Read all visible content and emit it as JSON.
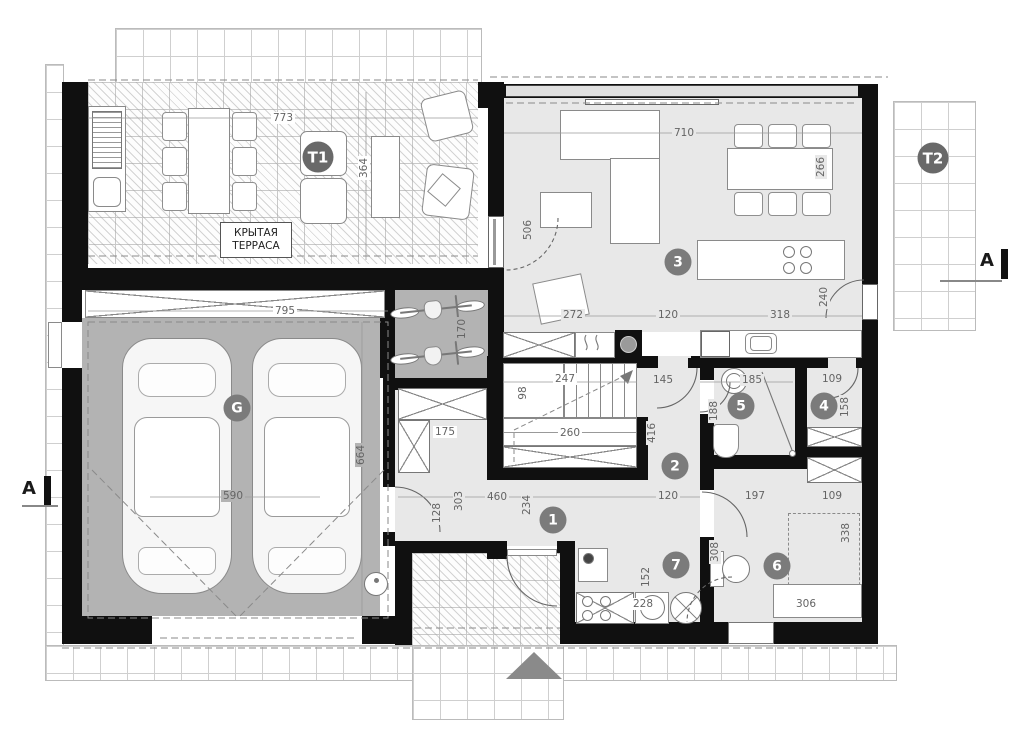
{
  "drawing": {
    "type": "architectural-floor-plan",
    "terrace_label": {
      "line1": "КРЫТАЯ",
      "line2": "ТЕРРАСА"
    },
    "section_label": "A",
    "colors": {
      "wall": "#101010",
      "interior_floor": "#e8e8e8",
      "garage_floor": "#b3b3b3",
      "badge": "#7b7b7b",
      "terrace_badge": "#696969",
      "dim_text": "#646464",
      "entry_arrow": "#8a8a8a"
    },
    "room_badges": [
      {
        "label": "T1",
        "x": 318,
        "y": 157,
        "kind": "t"
      },
      {
        "label": "T2",
        "x": 933,
        "y": 158,
        "kind": "t"
      },
      {
        "label": "G",
        "x": 237,
        "y": 408,
        "kind": "room"
      },
      {
        "label": "1",
        "x": 553,
        "y": 520,
        "kind": "room"
      },
      {
        "label": "2",
        "x": 675,
        "y": 466,
        "kind": "room"
      },
      {
        "label": "3",
        "x": 678,
        "y": 262,
        "kind": "room"
      },
      {
        "label": "4",
        "x": 824,
        "y": 406,
        "kind": "room"
      },
      {
        "label": "5",
        "x": 741,
        "y": 406,
        "kind": "room"
      },
      {
        "label": "6",
        "x": 777,
        "y": 566,
        "kind": "room"
      },
      {
        "label": "7",
        "x": 676,
        "y": 565,
        "kind": "room"
      }
    ],
    "dimensions": [
      {
        "text": "773",
        "x": 283,
        "y": 118,
        "rot": 0,
        "bg": "w"
      },
      {
        "text": "364",
        "x": 364,
        "y": 168,
        "rot": 90,
        "bg": "w"
      },
      {
        "text": "710",
        "x": 684,
        "y": 133,
        "rot": 0,
        "bg": "f"
      },
      {
        "text": "266",
        "x": 821,
        "y": 167,
        "rot": 90,
        "bg": "f"
      },
      {
        "text": "506",
        "x": 528,
        "y": 230,
        "rot": 90,
        "bg": "f"
      },
      {
        "text": "272",
        "x": 573,
        "y": 315,
        "rot": 0,
        "bg": "f"
      },
      {
        "text": "120",
        "x": 668,
        "y": 315,
        "rot": 0,
        "bg": "f"
      },
      {
        "text": "318",
        "x": 780,
        "y": 315,
        "rot": 0,
        "bg": "f"
      },
      {
        "text": "240",
        "x": 824,
        "y": 297,
        "rot": 90,
        "bg": "f"
      },
      {
        "text": "795",
        "x": 285,
        "y": 311,
        "rot": 0,
        "bg": "w"
      },
      {
        "text": "170",
        "x": 462,
        "y": 329,
        "rot": 90,
        "bg": "g"
      },
      {
        "text": "664",
        "x": 361,
        "y": 455,
        "rot": 90,
        "bg": "g"
      },
      {
        "text": "590",
        "x": 233,
        "y": 496,
        "rot": 0,
        "bg": "g"
      },
      {
        "text": "247",
        "x": 565,
        "y": 379,
        "rot": 0,
        "bg": "w"
      },
      {
        "text": "98",
        "x": 523,
        "y": 393,
        "rot": 90,
        "bg": "w"
      },
      {
        "text": "260",
        "x": 570,
        "y": 433,
        "rot": 0,
        "bg": "w"
      },
      {
        "text": "145",
        "x": 663,
        "y": 380,
        "rot": 0,
        "bg": "f"
      },
      {
        "text": "416",
        "x": 652,
        "y": 433,
        "rot": 90,
        "bg": "f"
      },
      {
        "text": "175",
        "x": 445,
        "y": 432,
        "rot": 0,
        "bg": "w"
      },
      {
        "text": "303",
        "x": 459,
        "y": 501,
        "rot": 90,
        "bg": "f"
      },
      {
        "text": "128",
        "x": 437,
        "y": 513,
        "rot": 90,
        "bg": "f"
      },
      {
        "text": "460",
        "x": 497,
        "y": 497,
        "rot": 0,
        "bg": "f"
      },
      {
        "text": "234",
        "x": 527,
        "y": 505,
        "rot": 90,
        "bg": "f"
      },
      {
        "text": "120",
        "x": 668,
        "y": 496,
        "rot": 0,
        "bg": "f"
      },
      {
        "text": "185",
        "x": 752,
        "y": 380,
        "rot": 0,
        "bg": "f"
      },
      {
        "text": "188",
        "x": 714,
        "y": 411,
        "rot": 90,
        "bg": "f"
      },
      {
        "text": "109",
        "x": 832,
        "y": 379,
        "rot": 0,
        "bg": "f"
      },
      {
        "text": "158",
        "x": 845,
        "y": 407,
        "rot": 90,
        "bg": "f"
      },
      {
        "text": "197",
        "x": 755,
        "y": 496,
        "rot": 0,
        "bg": "f"
      },
      {
        "text": "109",
        "x": 832,
        "y": 496,
        "rot": 0,
        "bg": "f"
      },
      {
        "text": "338",
        "x": 846,
        "y": 533,
        "rot": 90,
        "bg": "f"
      },
      {
        "text": "308",
        "x": 715,
        "y": 552,
        "rot": 90,
        "bg": "f"
      },
      {
        "text": "152",
        "x": 646,
        "y": 577,
        "rot": 90,
        "bg": "f"
      },
      {
        "text": "228",
        "x": 643,
        "y": 604,
        "rot": 0,
        "bg": "w"
      },
      {
        "text": "306",
        "x": 806,
        "y": 604,
        "rot": 0,
        "bg": "w"
      }
    ]
  }
}
